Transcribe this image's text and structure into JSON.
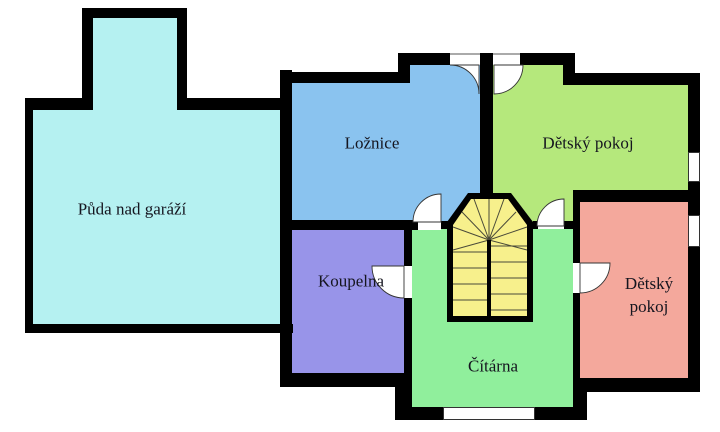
{
  "plan": {
    "type": "floor-plan",
    "background": "#ffffff",
    "wall_color": "#000000",
    "text_color": "#15151f"
  },
  "rooms": [
    {
      "name": "puda-nad-garazi",
      "label": "Půda nad garáží",
      "color": "#b5f1f1"
    },
    {
      "name": "loznice",
      "label": "Ložnice",
      "color": "#8ac3ef"
    },
    {
      "name": "detsky-pokoj-horni",
      "label": "Dětský pokoj",
      "color": "#b5e87c"
    },
    {
      "name": "koupelna",
      "label": "Koupelna",
      "color": "#9894e9"
    },
    {
      "name": "citarna",
      "label": "Čítárna",
      "color": "#90ef9c"
    },
    {
      "name": "detsky-pokoj-pravy",
      "label": "Dětský pokoj",
      "label_lines": [
        "Dětský",
        "pokoj"
      ],
      "color": "#f4a89c"
    }
  ],
  "stairs": {
    "name": "staircase",
    "color": "#f7f08c",
    "shape": "U-shaped winder staircase"
  },
  "features": {
    "door_count": 6,
    "window_count": 3
  }
}
